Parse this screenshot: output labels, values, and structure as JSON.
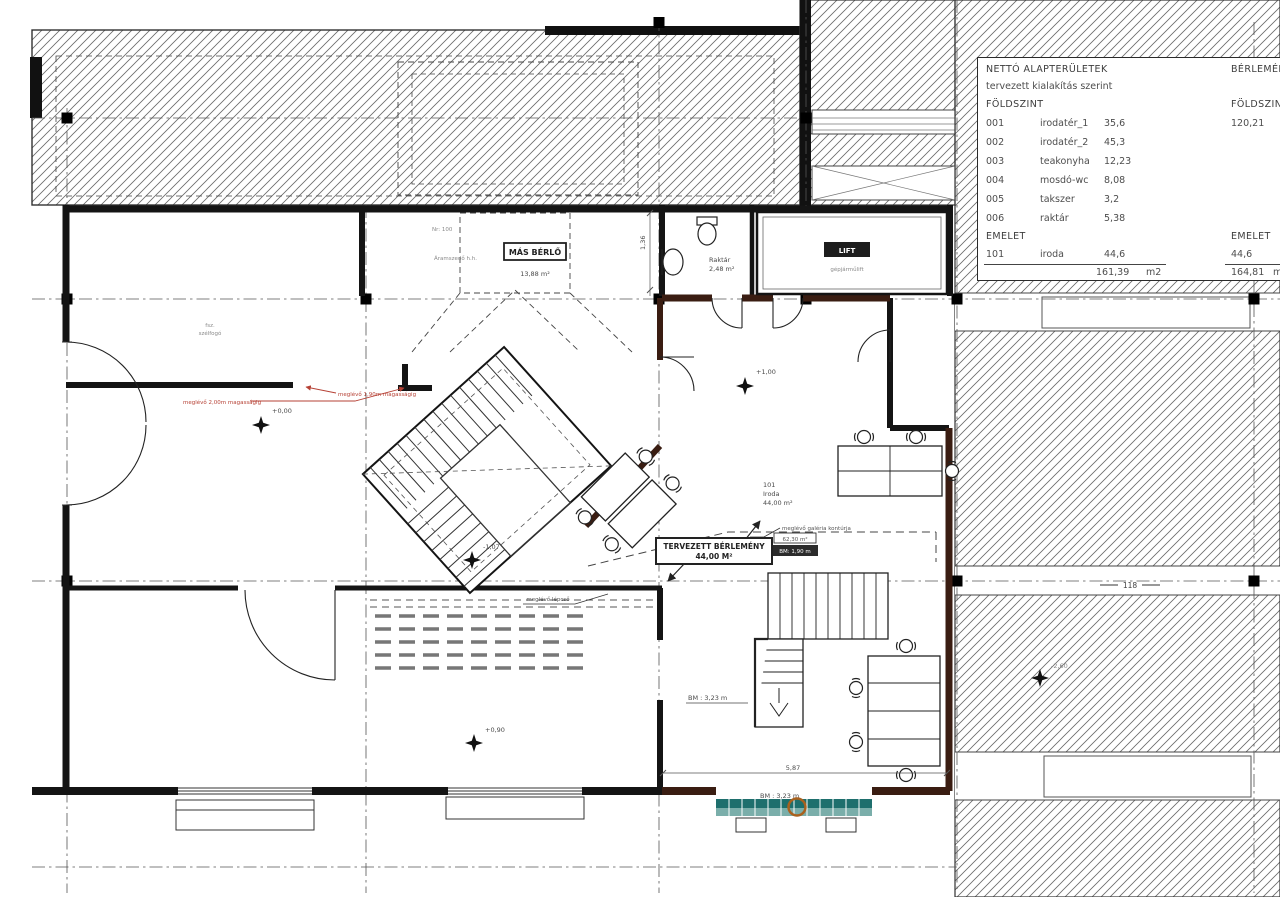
{
  "legend": {
    "title": "NETTÓ ALAPTERÜLETEK",
    "subtitle": "tervezett kialakítás szerint",
    "col_right_title": "BÉRLEMÉNY",
    "groundfloor_label": "FÖLDSZINT",
    "groundfloor_right_label": "FÖLDSZINT",
    "groundfloor_right_total": "120,21",
    "rooms": [
      {
        "num": "001",
        "name": "irodatér_1",
        "area": "35,6"
      },
      {
        "num": "002",
        "name": "irodatér_2",
        "area": "45,3"
      },
      {
        "num": "003",
        "name": "teakonyha",
        "area": "12,23"
      },
      {
        "num": "004",
        "name": "mosdó-wc",
        "area": "8,08"
      },
      {
        "num": "005",
        "name": "takszer",
        "area": "3,2"
      },
      {
        "num": "006",
        "name": "raktár",
        "area": "5,38"
      }
    ],
    "floor_label": "EMELET",
    "floor_right_label": "EMELET",
    "floor_room": {
      "num": "101",
      "name": "iroda",
      "area": "44,6"
    },
    "floor_right_total": "44,6",
    "total": "161,39",
    "total_unit": "m2",
    "right_total": "164,81",
    "right_total_unit": "m2"
  },
  "plan": {
    "mas_berlo": "MÁS BÉRLŐ",
    "mas_berlo_area": "13,88 m²",
    "raktar_name": "Raktár",
    "raktar_area": "2,48 m²",
    "lift_label": "LIFT",
    "lift_sub": "gépjárműlift",
    "room101_num": "101",
    "room101_name": "Iroda",
    "room101_area": "44,00 m²",
    "tervezett_title": "TERVEZETT BÉRLEMÉNY",
    "tervezett_area": "44,00 M²",
    "galeria_note": "meglévő galéria kontúrja",
    "galeria_val1": "62,30 m²",
    "galeria_val2": "BM: 1,90 m",
    "meglevo_lepcso": "meglévő lépcső",
    "bm_stair": "BM : 3,23 m",
    "bm_front": "BM : 3,23 m",
    "dim_front": "5,87",
    "dim_side": "1,36",
    "aramszedo": "Áramszedő h.h.",
    "nr_label": "Nr: 100",
    "szelfogo_l1": "fsz.",
    "szelfogo_l2": "szélfogó",
    "red_note_1": "meglévő 2,00m magasságig",
    "red_note_2": "meglévő 1,90m magasságig",
    "elev_0": "+0,00",
    "elev_1": "+1,00",
    "elev_m107": "-1,07",
    "elev_09": "+0,90",
    "elev_m26": "-2,60",
    "axis_118": "118"
  }
}
